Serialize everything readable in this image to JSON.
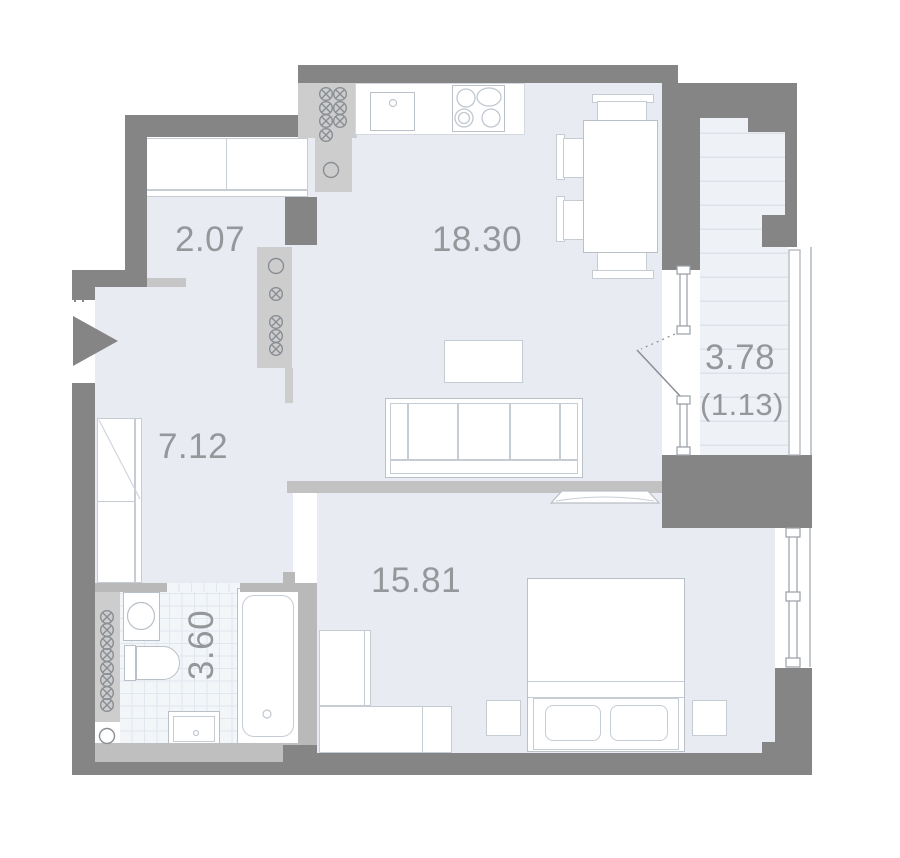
{
  "plan_title": "apartment-floor-plan",
  "rooms": {
    "hall": {
      "name": "entrance-hall",
      "area": "2.07"
    },
    "living_kitchen": {
      "name": "kitchen-living-room",
      "area": "18.30"
    },
    "corridor": {
      "name": "corridor",
      "area": "7.12"
    },
    "bathroom": {
      "name": "bathroom",
      "area": "3.60"
    },
    "bedroom": {
      "name": "bedroom",
      "area": "15.81"
    },
    "balcony": {
      "name": "balcony",
      "area": "3.78",
      "area_reduced": "(1.13)"
    }
  },
  "colors": {
    "outer_wall": "#858585",
    "partition_wall": "#b9b9b9",
    "shaft": "#cdcdcd",
    "floor": "#e8ebf1",
    "balcony_floor": "#eef1f6",
    "bathroom_tile_line": "#e1e7ee",
    "label_text": "#95979a",
    "fixture_stroke": "#c2c8d0"
  },
  "icons": {
    "vent_stack": "circle-with-diagonal-cross",
    "plumbing_riser": "plain-circle",
    "entrance_arrow": "right-pointing-triangle"
  }
}
